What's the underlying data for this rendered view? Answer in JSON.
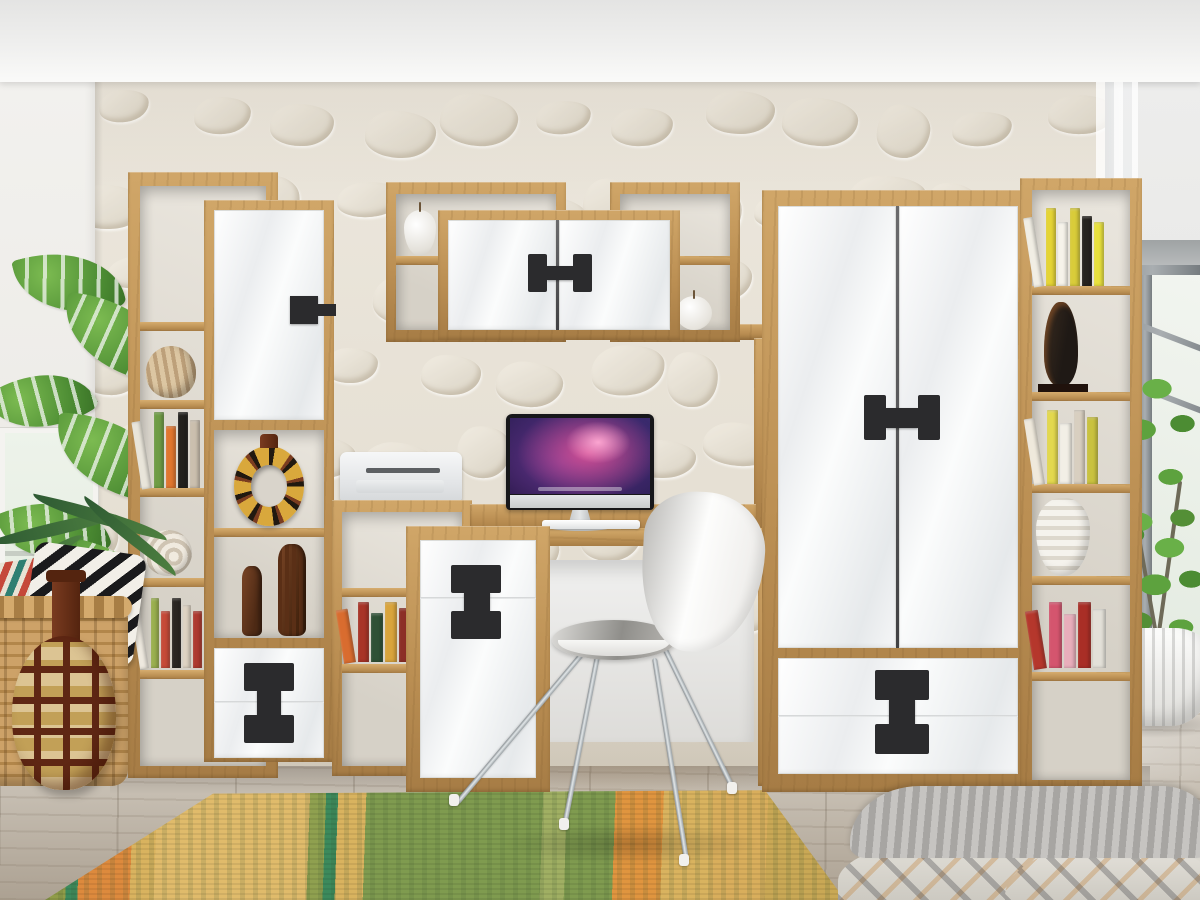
{
  "scene": {
    "description": "3D interior render of a teen-room wall unit set in oak and gloss white with black dumbbell-shaped handles",
    "room": {
      "wall_left": "white painted wall with window and monstera plant",
      "wall_accent": "white embossed stone 3D panel",
      "wall_right": "grey wall with metal frame window, sheer curtain and ficus tree",
      "floor": "weathered grey wood planks",
      "ceiling": "white ceiling with dropped soffit"
    },
    "furniture": {
      "left_shelf": {
        "label": "Tall open shelving column (oak)"
      },
      "left_cabinet": {
        "label": "Cabinet with gloss white door, open niche and two drawers"
      },
      "mid_shelf": {
        "label": "Low stepped bookshelf (oak)"
      },
      "small_cabinet": {
        "label": "Small cabinet with drawer and door"
      },
      "desk": {
        "label": "Writing desk (oak)"
      },
      "wall_box_left": {
        "label": "Wall shelf box left"
      },
      "wall_cabinet": {
        "label": "Wall-mounted two-door cabinet"
      },
      "wall_box_right": {
        "label": "Wall shelf box right"
      },
      "wardrobe": {
        "label": "Two-door wardrobe with two drawers"
      },
      "right_shelf": {
        "label": "Tall open shelving column right (oak)"
      },
      "chair": {
        "label": "White shell chair with chrome legs"
      }
    },
    "electronics": {
      "imac": {
        "label": "All-in-one computer with purple galaxy wallpaper"
      },
      "printer": {
        "label": "White compact printer"
      }
    },
    "decor": {
      "striped_pot": {
        "label": "Beige striped clay pot"
      },
      "nautilus_shell": {
        "label": "White nautilus shell"
      },
      "ring_vase": {
        "label": "African ring-shaped vase"
      },
      "figurines": {
        "label": "Two carved wooden tribal figurines"
      },
      "pear": {
        "label": "White ceramic pear"
      },
      "apple": {
        "label": "White ceramic apple"
      },
      "sculpture": {
        "label": "Black abstract figurine"
      },
      "white_vase": {
        "label": "White ribbed vase"
      },
      "floor_vase": {
        "label": "Patterned gourd floor vase"
      },
      "basket": {
        "label": "Wicker basket with pillows"
      },
      "pillow_bw": {
        "label": "Black and white triangle pillow"
      },
      "pillow_ethnic": {
        "label": "Red and teal ethnic pillow"
      },
      "bed": {
        "label": "Bed corner with knit blanket and patterned duvet"
      },
      "planter": {
        "label": "Large white ribbed planter"
      },
      "plant_left": {
        "label": "Monstera plant"
      },
      "plant_right": {
        "label": "Ficus tree"
      },
      "rug": {
        "label": "Orange-green ethnic runner rug"
      },
      "books_left_a": {
        "spines": [
          "#e9e5da",
          "#6f9c45",
          "#e0762f",
          "#23211d",
          "#cbbfae"
        ]
      },
      "books_left_b": {
        "spines": [
          "#eee9df",
          "#9ab04f",
          "#c64a38",
          "#2a2622",
          "#ded3c2",
          "#ae3a30"
        ]
      },
      "books_mid": {
        "spines": [
          "#d96c2f",
          "#a83427",
          "#2f5136",
          "#d9a43c",
          "#8c2f27",
          "#c75b2e"
        ]
      },
      "books_right_top": {
        "spines": [
          "#f1eee4",
          "#e5d435",
          "#f6f3ea",
          "#d9cc3a",
          "#26231f",
          "#e8e13e"
        ]
      },
      "books_right_mid": {
        "spines": [
          "#efe9dc",
          "#e3d84e",
          "#f2efe6",
          "#d8cfc0",
          "#c9c23f"
        ]
      },
      "books_right_low": {
        "spines": [
          "#b5372c",
          "#d4556e",
          "#e8aebb",
          "#a92e26",
          "#e3e0d8"
        ]
      }
    }
  },
  "palette": {
    "oak": "#bf9257",
    "oak_light": "#d2a96e",
    "oak_dark": "#8f6a3c",
    "white_gloss": "#f4f5f6",
    "handle": "#2b2b2d",
    "wall": "#f3f2ef",
    "stone": "#eae4d9",
    "stone_line": "#cfc7b6",
    "wall_right": "#e7e7e6",
    "floor": "#c9c1b6",
    "floor_dark": "#a99f92",
    "rug_orange": "#dd8a3d",
    "rug_green": "#909c48",
    "rug_teal": "#3c8a5c",
    "rug_sand": "#d9b35f",
    "leaf": "#5fa23d",
    "leaf_dark": "#39702a",
    "screen_pink": "#d8538e",
    "screen_purple": "#3a2a6e",
    "screen_dark": "#201440",
    "chrome": "#b9bfc3",
    "basket": "#c59a5d",
    "vase_brown": "#6e3319"
  }
}
